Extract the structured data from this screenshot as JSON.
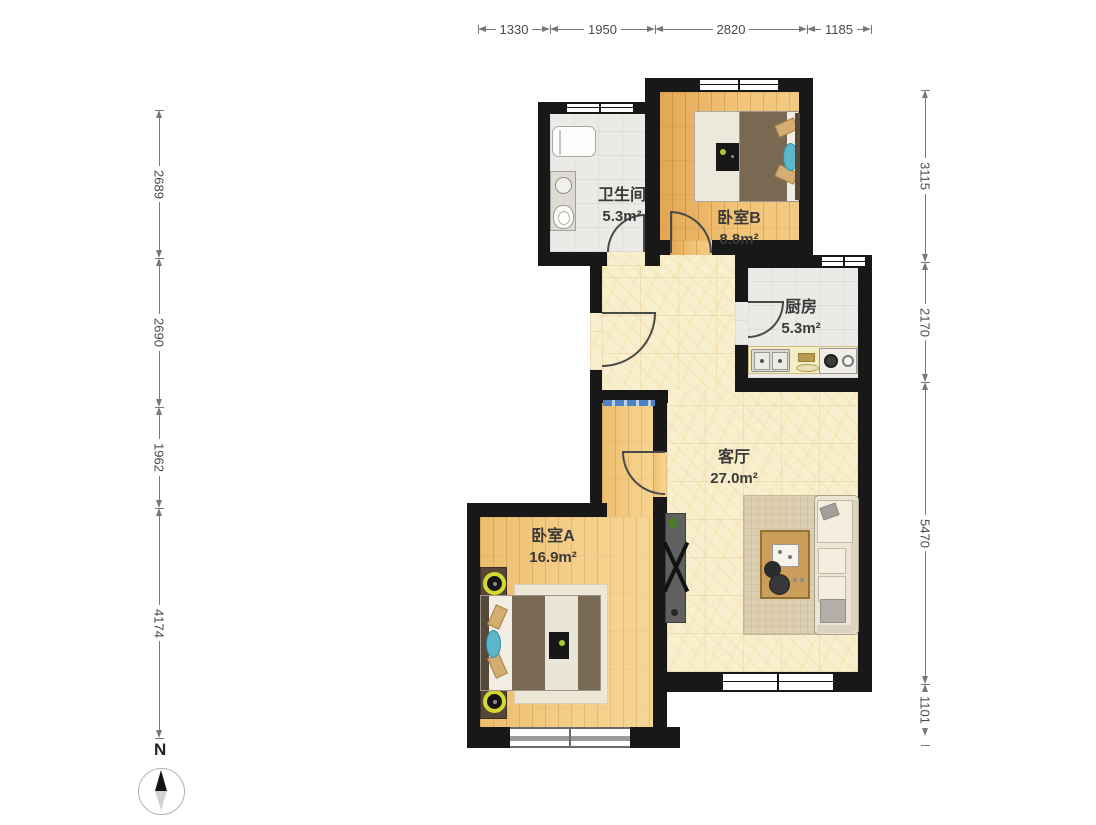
{
  "dimensions": {
    "top": {
      "labels": [
        "1330",
        "1950",
        "2820",
        "1185"
      ]
    },
    "left": {
      "labels": [
        "2689",
        "2690",
        "1962",
        "4174"
      ]
    },
    "right": {
      "labels": [
        "3115",
        "2170",
        "5470",
        "1101"
      ]
    }
  },
  "rooms": {
    "bathroom": {
      "name": "卫生间",
      "area": "5.3m²"
    },
    "bedroom_b": {
      "name": "卧室B",
      "area": "8.8m²"
    },
    "kitchen": {
      "name": "厨房",
      "area": "5.3m²"
    },
    "living_room": {
      "name": "客厅",
      "area": "27.0m²"
    },
    "bedroom_a": {
      "name": "卧室A",
      "area": "16.9m²"
    }
  },
  "compass": {
    "north_label": "N"
  },
  "colors": {
    "wall": "#181818",
    "wood_bedroom_a": "#f2c87e",
    "wood_bedroom_b": "#eeb968",
    "marble_living": "#f8efcf",
    "tile_gray": "#eceae6",
    "accent_teal": "#5bb7c9",
    "accent_green": "#aacc33",
    "threshold_blue": "#4d82c4",
    "lamp_yellow": "#d6d832"
  }
}
